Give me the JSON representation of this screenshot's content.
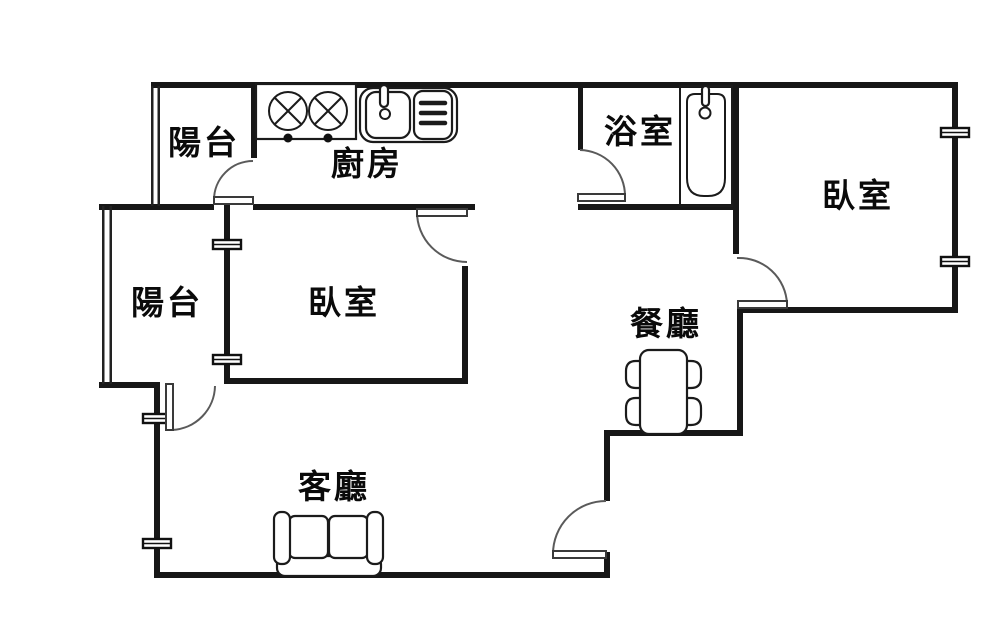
{
  "plan": {
    "title": "apartment-floor-plan",
    "background_color": "#ffffff",
    "wall_color": "#171717",
    "rooms": {
      "balcony_top": {
        "label": "陽台"
      },
      "kitchen": {
        "label": "廚房"
      },
      "bathroom": {
        "label": "浴室"
      },
      "bedroom_right": {
        "label": "臥室"
      },
      "balcony_left": {
        "label": "陽台"
      },
      "bedroom_left": {
        "label": "臥室"
      },
      "dining": {
        "label": "餐廳"
      },
      "living": {
        "label": "客廳"
      }
    },
    "fixtures": [
      "stove-two-burner-icon",
      "kitchen-sink-icon",
      "dish-rack-icon",
      "bathtub-icon",
      "dining-table-with-four-chairs-icon",
      "two-seat-sofa-icon"
    ],
    "counts": {
      "doors": 6,
      "window_markers": 6,
      "rooms": 8
    }
  }
}
